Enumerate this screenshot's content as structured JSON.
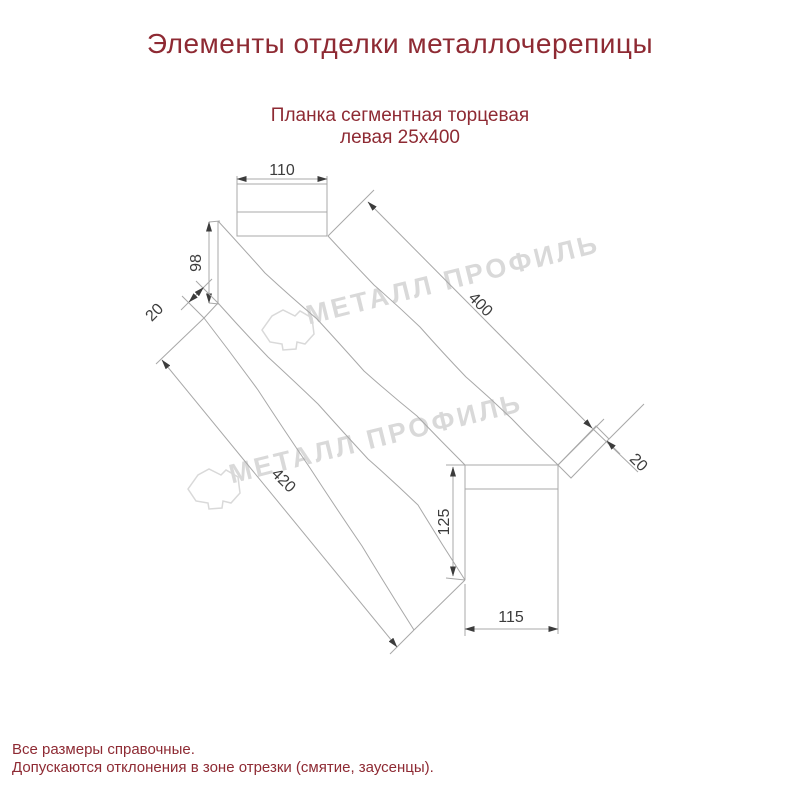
{
  "colors": {
    "background": "#ffffff",
    "accent_text": "#8e2a33",
    "drawing_lines": "#a8a8a8",
    "dimension_text": "#3c3c3c",
    "watermark": "#d9d9d9"
  },
  "header": {
    "title": "Элементы отделки металлочерепицы"
  },
  "product": {
    "name_line1": "Планка сегментная торцевая",
    "name_line2": "левая 25х400"
  },
  "drawing": {
    "dimensions": {
      "top_flange_width": "110",
      "left_end_height": "98",
      "left_hem": "20",
      "top_length": "400",
      "right_hem": "20",
      "bottom_length": "420",
      "right_end_height": "125",
      "bottom_flange_width": "115"
    }
  },
  "watermark": {
    "text": "МЕТАЛЛ ПРОФИЛЬ"
  },
  "footer": {
    "note_line1": "Все размеры справочные.",
    "note_line2": "Допускаются отклонения в зоне отрезки (смятие, заусенцы)."
  }
}
